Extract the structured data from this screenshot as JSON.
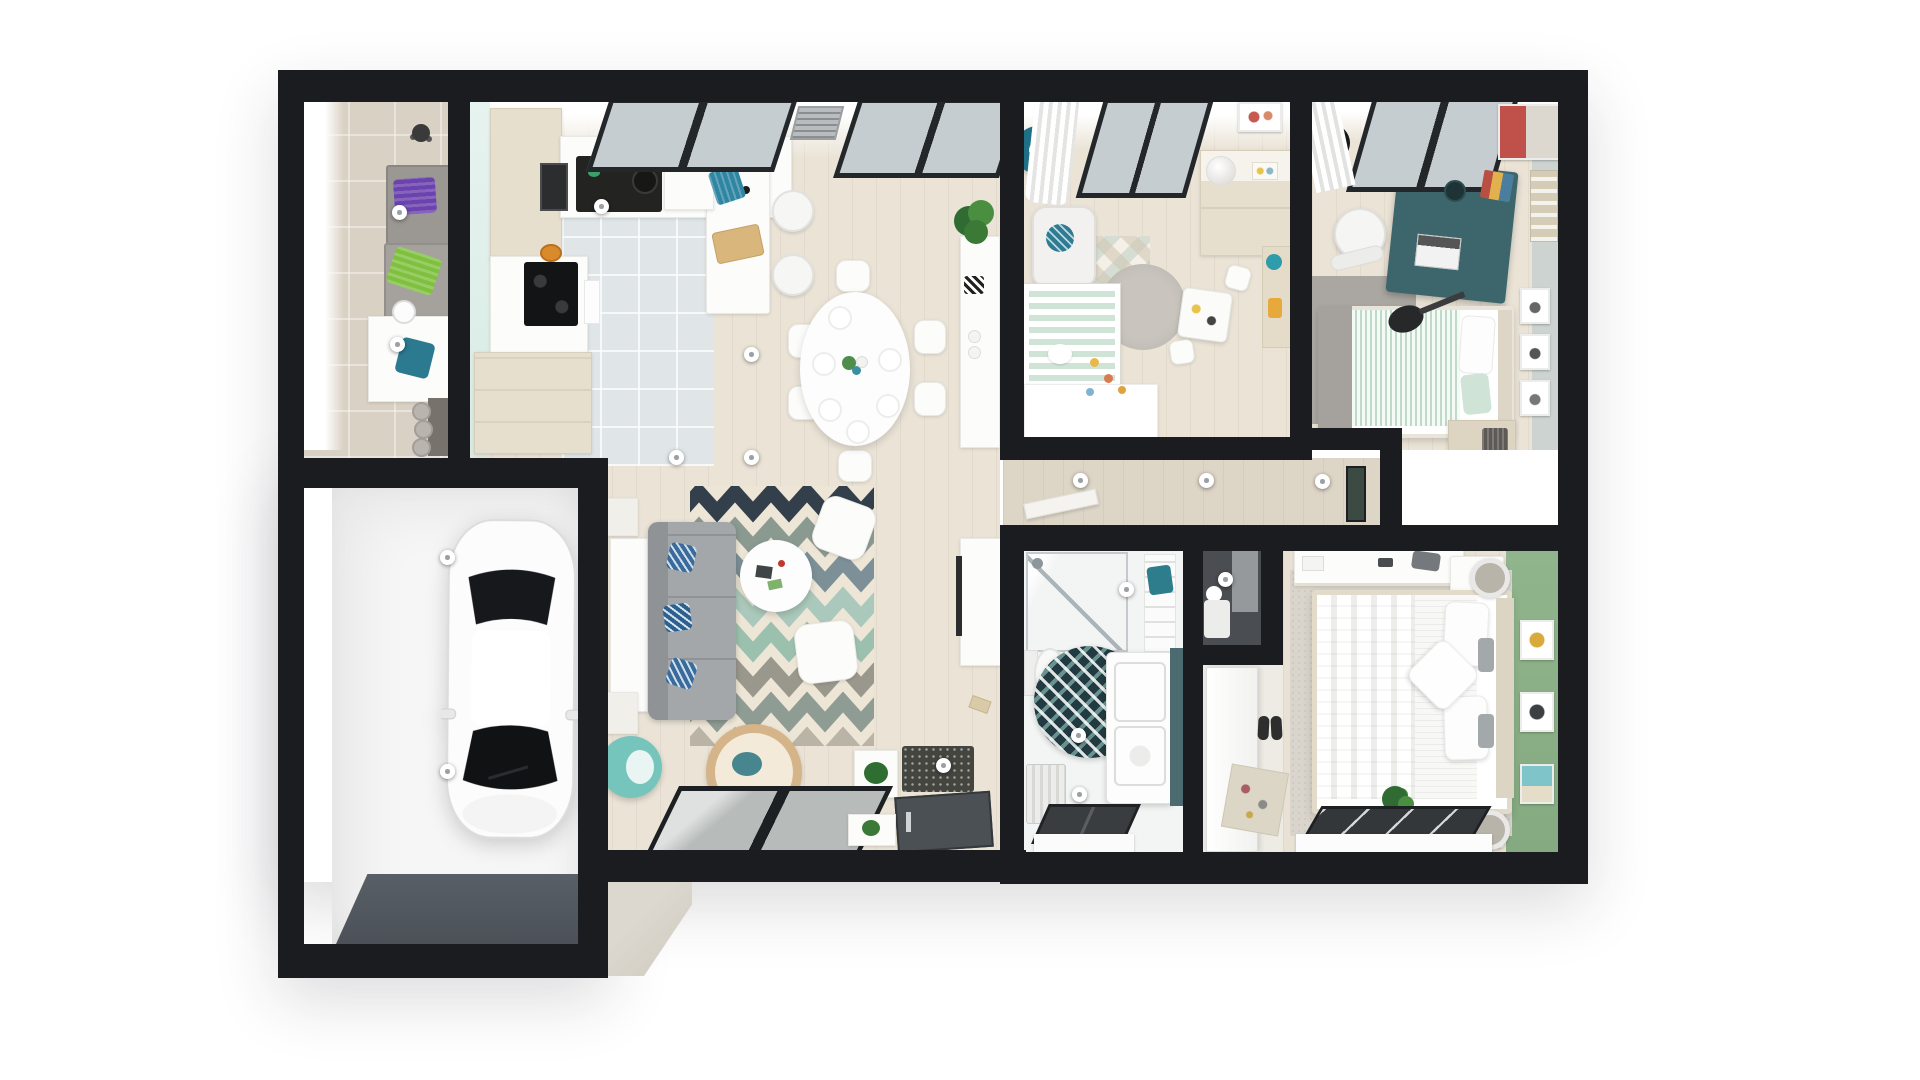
{
  "view": {
    "type": "floor-plan-3d-overhead-render",
    "background": "#ffffff",
    "width": 1920,
    "height": 1080
  },
  "palette": {
    "wall": "#1a1c1f",
    "floor_wood": "#eae3d6",
    "hall_wood": "#ddd5c6",
    "kitchen_tile": "#e0e6e8",
    "laundry_tile": "#d9d1c3",
    "garage_floor": "#f6f6f6",
    "garage_door": "#53595f",
    "green_wall": "#8db189",
    "teen_wall": "#ccd3d0",
    "mint_wall": "#e2f1ec",
    "teal_accent": "#2f7b92",
    "teal_ball_chair": "#76c5bd",
    "sofa_gray": "#a3a7aa",
    "rug_cream": "#ede5d5",
    "rug_stripes": [
      "#333f4b",
      "#8b9a91",
      "#7d9097",
      "#aac8bb",
      "#9cc0ae",
      "#9a978c",
      "#8f9c94",
      "#b9b4a6"
    ],
    "bathroom_rug": "#223a41",
    "crib_mint": "#cfe4d6",
    "teen_desk": "#3c666c"
  },
  "rooms": [
    {
      "id": "laundry-room",
      "features": [
        "window-light-strip",
        "stacked-washer-dryer",
        "purple-towel",
        "green-towel",
        "white-counter",
        "teal-towel",
        "round-sink",
        "baskets"
      ]
    },
    {
      "id": "kitchen",
      "features": [
        "mint-wall",
        "tall-beige-cabinets",
        "wall-oven",
        "black-sink",
        "fridge",
        "cooktop",
        "u-counter",
        "island",
        "two-white-stools",
        "cutting-board",
        "teal-towel",
        "skylight-windows",
        "vent-grille",
        "tiled-floor"
      ]
    },
    {
      "id": "dining-area",
      "features": [
        "oval-white-table",
        "six-white-chairs",
        "place-settings",
        "flower-centerpiece",
        "corner-plant",
        "white-sideboard",
        "zigzag-mug"
      ]
    },
    {
      "id": "living-room",
      "features": [
        "chevron-rug",
        "gray-sofa",
        "three-blue-pillows",
        "console-behind-sofa",
        "round-coffee-table",
        "two-white-poufs",
        "hanging-rattan-chair",
        "teal-ball-chair",
        "tv-console",
        "remote",
        "sliding-glass-door",
        "speckled-doormat",
        "front-door",
        "white-planters"
      ]
    },
    {
      "id": "garage",
      "features": [
        "white-car",
        "side-mirrors",
        "garage-door-strip"
      ]
    },
    {
      "id": "nursery",
      "features": [
        "curtain",
        "window",
        "teal-drum-lamp",
        "wall-art",
        "changing-dresser",
        "white-ball-lamp",
        "armchair",
        "teal-cushion",
        "diamond-play-mat",
        "crib-mint-mattress",
        "round-gray-rug",
        "kids-table",
        "two-kids-chairs",
        "wall-shelf",
        "white-wardrobe",
        "scattered-toys"
      ]
    },
    {
      "id": "teen-bedroom",
      "features": [
        "vinyl-record",
        "curtain",
        "window",
        "poster",
        "teal-desk",
        "laptop",
        "speaker",
        "books",
        "white-desk-chair",
        "magazine-rack",
        "guitar",
        "gray-rug",
        "single-bed-mint-duvet",
        "gray-throw",
        "pillow",
        "headboard",
        "three-wall-frames",
        "dresser",
        "laundry-basket"
      ]
    },
    {
      "id": "hallway",
      "features": [
        "wall-shelf",
        "picture-frame",
        "three-hotspots"
      ]
    },
    {
      "id": "wc-utility",
      "features": [
        "dark-walls",
        "water-heater"
      ]
    },
    {
      "id": "bathroom",
      "features": [
        "walk-in-shower",
        "shower-head",
        "towel-radiator",
        "teal-towel",
        "toilet",
        "round-patterned-rug",
        "double-sink-vanity",
        "teal-side-panel",
        "radiator",
        "floor-window"
      ]
    },
    {
      "id": "entry-closet",
      "features": [
        "white-door-leaf",
        "pair-of-shoes",
        "jewelry-tray"
      ]
    },
    {
      "id": "master-bedroom",
      "features": [
        "green-accent-wall",
        "dresser-with-accessories",
        "double-bed",
        "white-duvet",
        "two-pillows",
        "diamond-pillow",
        "gray-accent-pillows",
        "headboard",
        "two-nightstands",
        "two-lamps",
        "textured-rug",
        "three-wall-frames",
        "plant",
        "window"
      ]
    }
  ],
  "hotspots": [
    {
      "x": 400,
      "y": 213
    },
    {
      "x": 398,
      "y": 345
    },
    {
      "x": 602,
      "y": 207
    },
    {
      "x": 752,
      "y": 355
    },
    {
      "x": 677,
      "y": 458
    },
    {
      "x": 752,
      "y": 458
    },
    {
      "x": 448,
      "y": 558
    },
    {
      "x": 448,
      "y": 772
    },
    {
      "x": 944,
      "y": 766
    },
    {
      "x": 1081,
      "y": 481
    },
    {
      "x": 1207,
      "y": 481
    },
    {
      "x": 1323,
      "y": 482
    },
    {
      "x": 1127,
      "y": 590
    },
    {
      "x": 1079,
      "y": 736
    },
    {
      "x": 1080,
      "y": 795
    },
    {
      "x": 1226,
      "y": 580
    }
  ]
}
